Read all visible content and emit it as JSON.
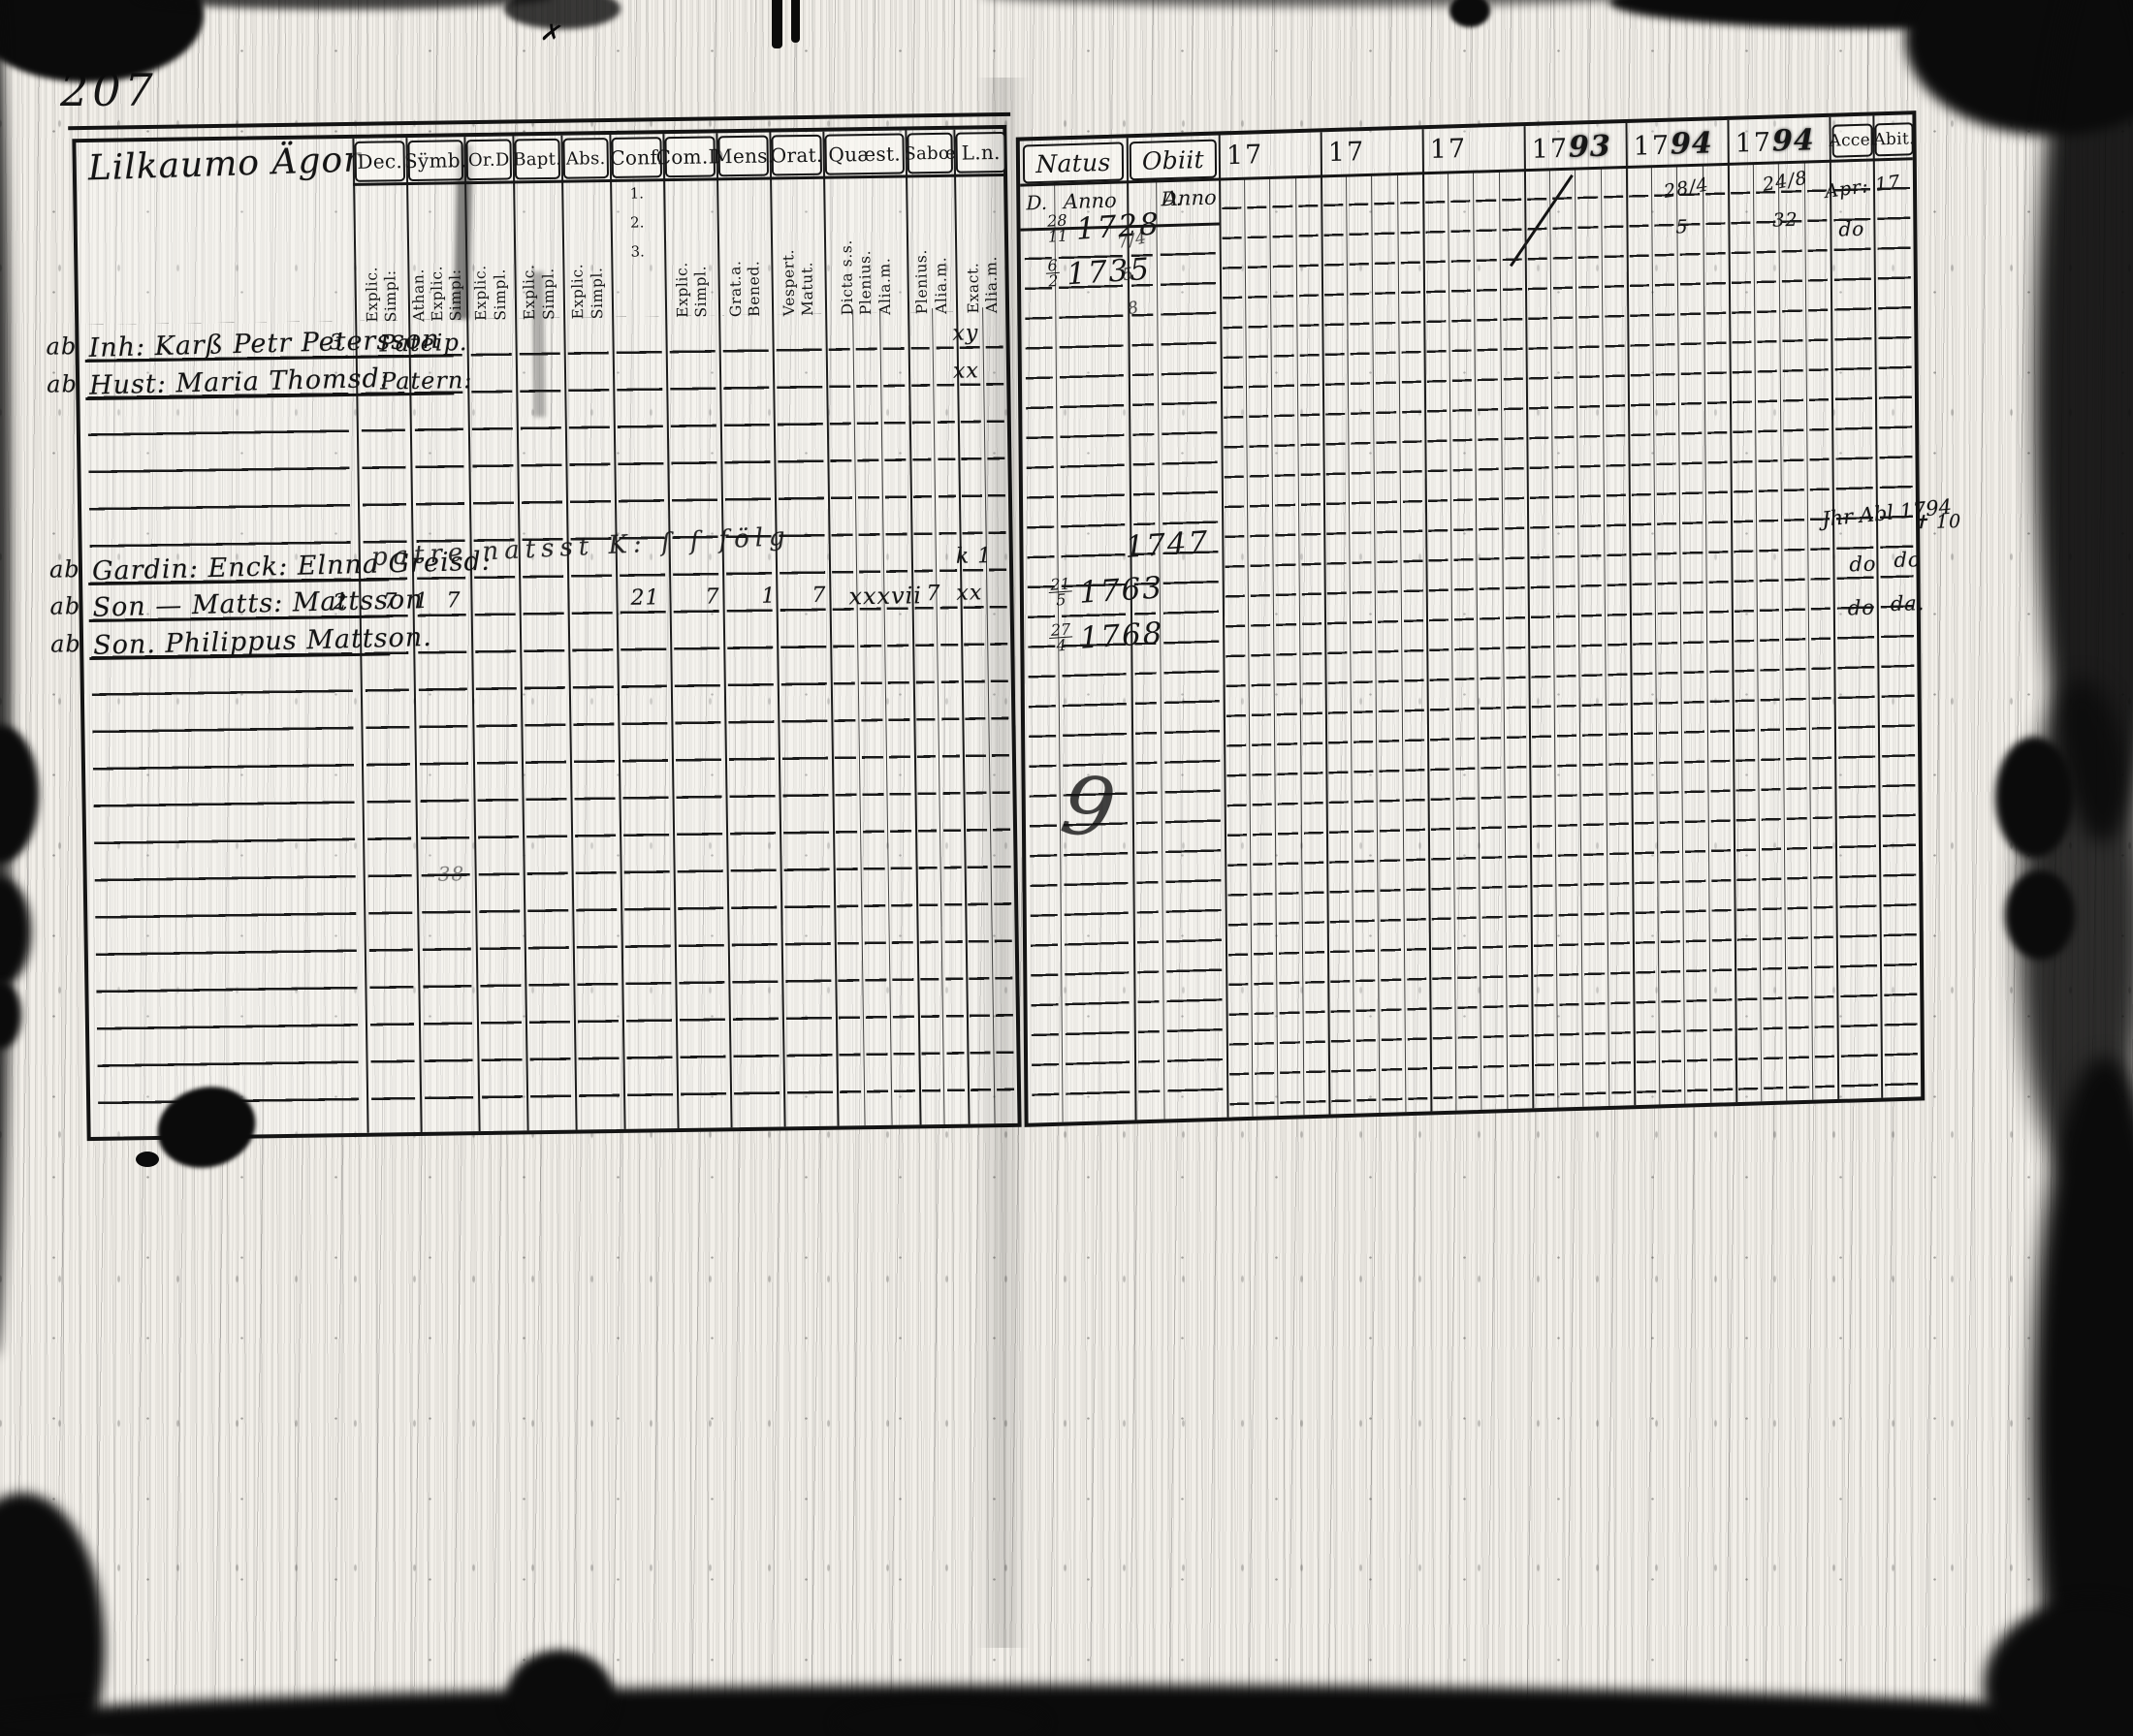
{
  "page_number": "207",
  "left_page": {
    "title_script": "Lilkaumo Ägor",
    "columns": [
      {
        "key": "dec",
        "label": "Dec.",
        "sub": [
          "Explic.",
          "Simpl:"
        ]
      },
      {
        "key": "simb",
        "label": "Sÿmb.",
        "sub": [
          "Athan.",
          "Explic.",
          "Simpl:"
        ]
      },
      {
        "key": "ord",
        "label": "Or.D",
        "sub": [
          "Explic.",
          "Simpl."
        ]
      },
      {
        "key": "bapt",
        "label": "Bapt.",
        "sub": [
          "Explic.",
          "Simpl."
        ]
      },
      {
        "key": "abs",
        "label": "Abs.",
        "sub": [
          "Explic.",
          "Simpl."
        ]
      },
      {
        "key": "conf",
        "label": "Conf.",
        "sub": [
          "1.",
          "2.",
          "3."
        ]
      },
      {
        "key": "comd",
        "label": "Com.D",
        "sub": [
          "Explic.",
          "Simpl."
        ]
      },
      {
        "key": "mens",
        "label": "Mens.",
        "sub": [
          "Grat.a.",
          "Bened."
        ]
      },
      {
        "key": "orat",
        "label": "Orat.",
        "sub": [
          "Vespert.",
          "Matut."
        ]
      },
      {
        "key": "quaest",
        "label": "Quæst.",
        "sub": [
          "Dicta s.s.",
          "Plenius.",
          "Alia.m."
        ]
      },
      {
        "key": "sabo",
        "label": "Sabœ",
        "sub": [
          "Plenius.",
          "Alia.m."
        ]
      },
      {
        "key": "ln",
        "label": "L.n.",
        "sub": [
          "Exact.",
          "Alia.m."
        ]
      }
    ],
    "entries": [
      {
        "margin": "ab",
        "name": "Inh: Karß Petr Petersson",
        "row": 1,
        "marks": [
          {
            "col": "dec",
            "text": "3"
          },
          {
            "col": "simb",
            "text": "Pateip."
          },
          {
            "col": "ln",
            "text": "xy"
          }
        ]
      },
      {
        "margin": "ab",
        "name": "Hust: Maria Thomsd:",
        "row": 2,
        "marks": [
          {
            "col": "simb",
            "text": "Patern:"
          },
          {
            "col": "ln",
            "text": "xx"
          }
        ]
      },
      {
        "margin": "ab",
        "name": "Gardin: Enck: Elnna Greisd:",
        "row": 7,
        "overlay": "patre natsst K: ſ ſ fölg",
        "marks": [
          {
            "col": "ln",
            "text": "k 1"
          }
        ]
      },
      {
        "margin": "ab",
        "name": "Son — Matts: Mattsson",
        "row": 8,
        "marks": [
          {
            "col": "dec",
            "text": "2"
          },
          {
            "col": "simb",
            "text": "7"
          },
          {
            "col": "ord",
            "text": "1"
          },
          {
            "col": "bapt",
            "text": "7"
          },
          {
            "col": "conf",
            "text": "21"
          },
          {
            "col": "comd",
            "text": "7"
          },
          {
            "col": "mens",
            "text": "1"
          },
          {
            "col": "orat",
            "text": "7"
          },
          {
            "col": "quaest",
            "text": "xxxvii"
          },
          {
            "col": "sabo",
            "text": "7"
          },
          {
            "col": "ln",
            "text": "xx"
          }
        ]
      },
      {
        "margin": "ab",
        "name": "Son. Philippus Mattson.",
        "row": 9,
        "marks": []
      }
    ],
    "faint_mark": "38"
  },
  "right_page": {
    "natus_label": "Natus",
    "obiit_label": "Obiit",
    "day_label": "D.",
    "anno_label": "Anno",
    "years": [
      {
        "printed": "17",
        "script": ""
      },
      {
        "printed": "17",
        "script": ""
      },
      {
        "printed": "17",
        "script": ""
      },
      {
        "printed": "17",
        "script": "93"
      },
      {
        "printed": "17",
        "script": "94"
      },
      {
        "printed": "17",
        "script": "94"
      }
    ],
    "accel_label": "Accel",
    "abit_label": "Abit.",
    "entries": [
      {
        "natus_day": "28/11",
        "natus_anno": "1728",
        "row": 2
      },
      {
        "natus_day": "6/2",
        "natus_anno": "1735",
        "row": 3.5
      },
      {
        "natus_day": "",
        "natus_anno": "1747",
        "row": 12.7
      },
      {
        "natus_day": "21/5",
        "natus_anno": "1763",
        "row": 14.2
      },
      {
        "natus_day": "27/4",
        "natus_anno": "1768",
        "row": 15.7
      }
    ],
    "margin_marks": {
      "obiit_squiggles": [
        "7/4",
        "5",
        "8"
      ],
      "y1794a": [
        "28/4",
        "5"
      ],
      "y1794b": [
        "24/8",
        "32"
      ],
      "accel_row1": "Apr: 17",
      "abit_row1": "do",
      "accel_scrawl": "Jhr Abl 1794",
      "abit_cross": "✝ 10",
      "ditto_row8": [
        "do",
        "do"
      ],
      "ditto_row9": [
        "do",
        "da."
      ],
      "stray_nine": "9"
    }
  }
}
